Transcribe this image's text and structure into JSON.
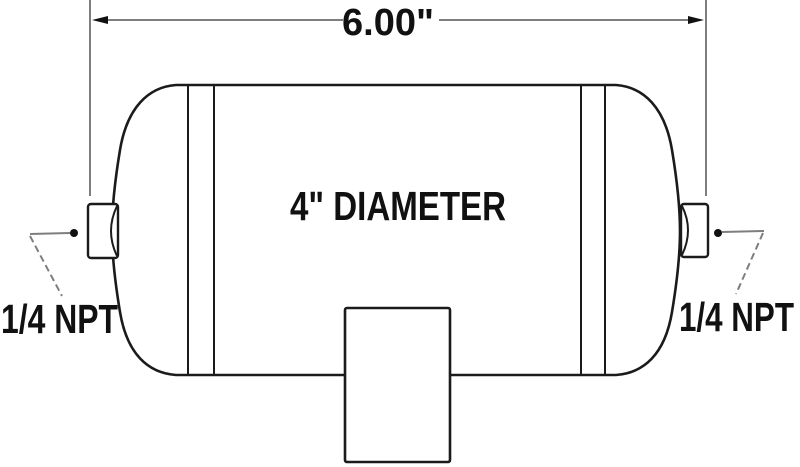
{
  "labels": {
    "length_dimension": "6.00\"",
    "diameter": "4\" DIAMETER",
    "left_port": "1/4 NPT",
    "right_port": "1/4 NPT"
  },
  "colors": {
    "background": "#ffffff",
    "outline": "#1b1b1b",
    "dimension_lines": "#7e7e7e",
    "text": "#111111"
  }
}
